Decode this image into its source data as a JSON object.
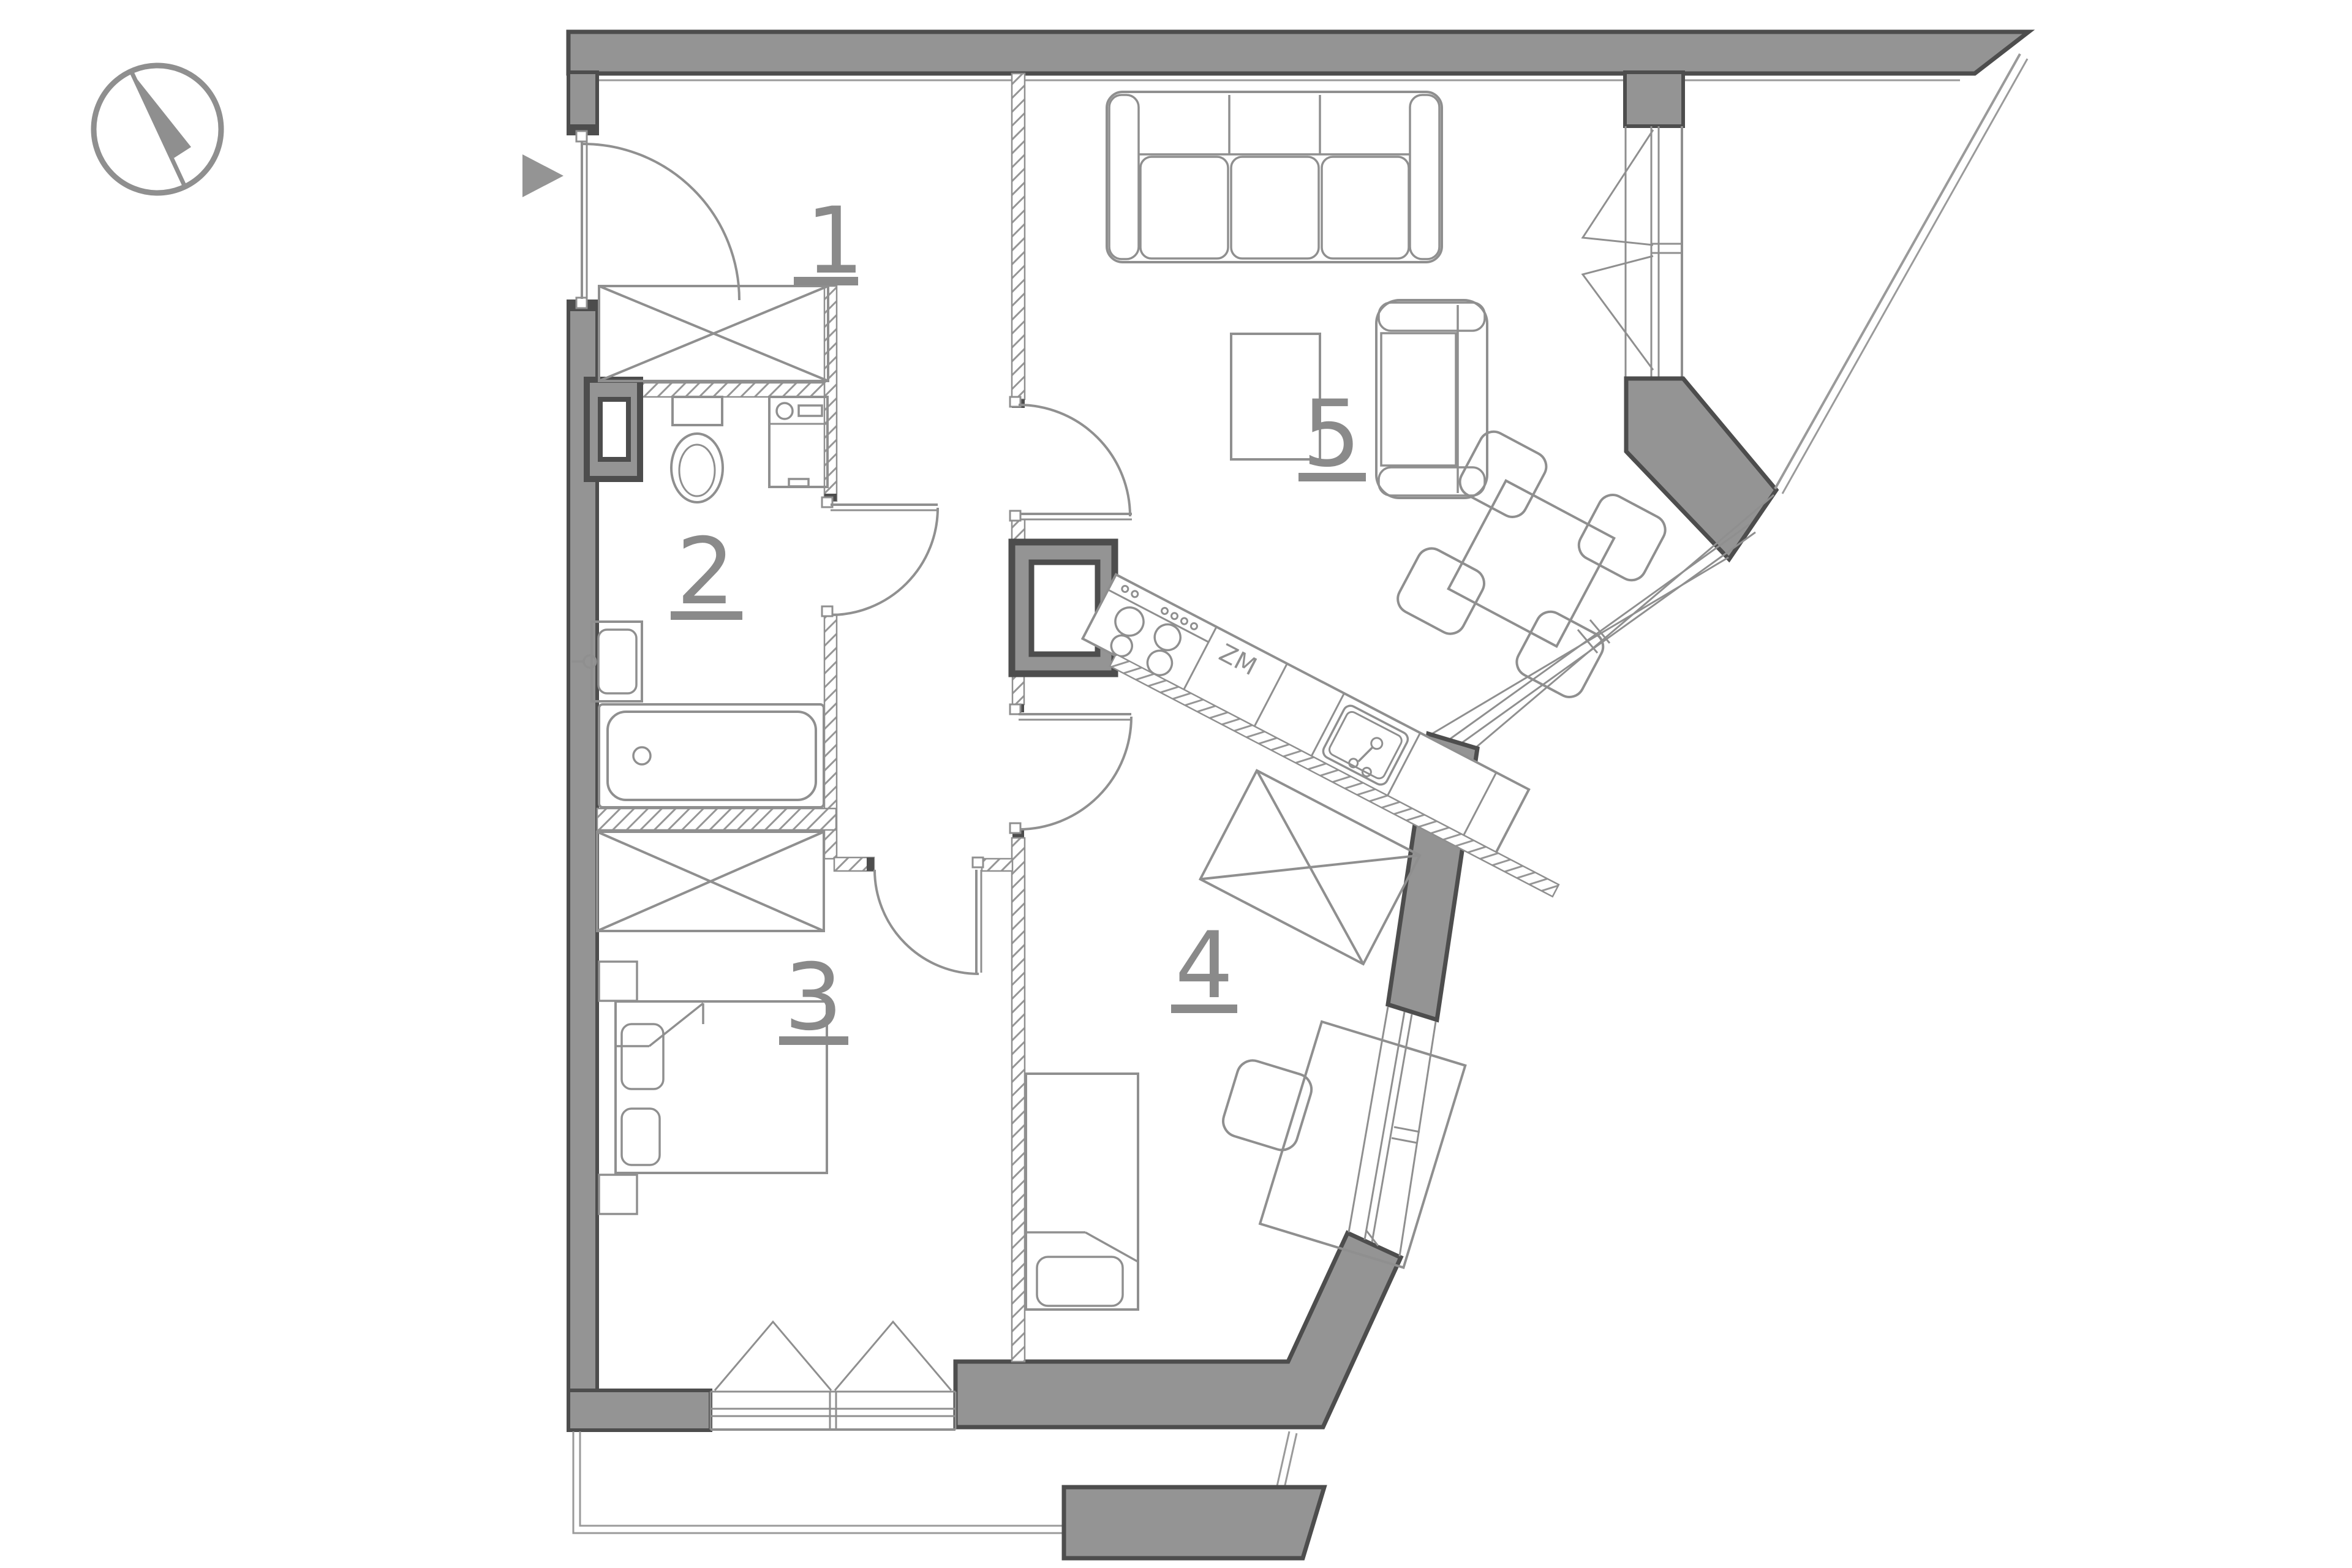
{
  "plan": {
    "type": "apartment-floor-plan",
    "rooms": [
      {
        "number": "1",
        "role": "hall"
      },
      {
        "number": "2",
        "role": "bathroom"
      },
      {
        "number": "3",
        "role": "bedroom"
      },
      {
        "number": "4",
        "role": "bedroom-office"
      },
      {
        "number": "5",
        "role": "living-room-kitchen"
      }
    ],
    "kitchen": {
      "zm_label": "ZM"
    },
    "colors": {
      "wall_fill": "#949494",
      "wall_outline": "#4d4d4d",
      "line": "#8f8f8f",
      "thin_line": "#9a9a9a",
      "label": "#8a8a8a",
      "background": "#ffffff"
    },
    "symbols": [
      "north-compass",
      "entrance-arrow",
      "door-swings",
      "casement-windows",
      "wardrobe-x",
      "balcony-outline"
    ]
  }
}
